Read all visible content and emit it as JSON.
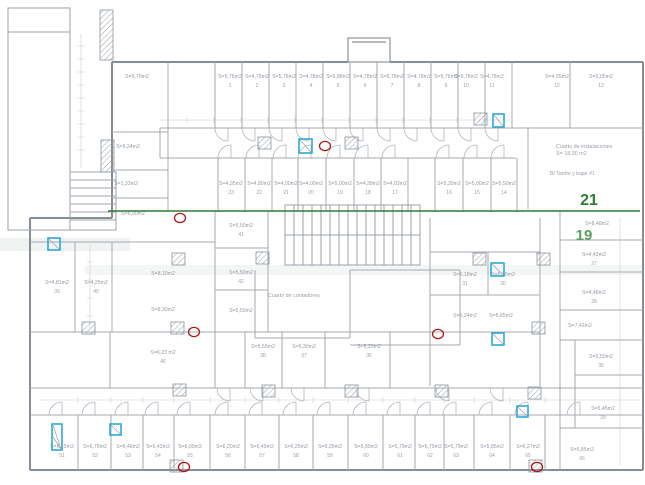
{
  "colors": {
    "wall": "#858d96",
    "partition": "#a4aab2",
    "thin": "#bfc5cb",
    "label_text": "#939aa3",
    "green_line": "#2e7d32",
    "green_label_21": "#2e7d32",
    "green_label_19": "#58a05c",
    "blue_marker": "#2fa8d5",
    "red_marker": "#b01818",
    "hatch": "#9aa1a9"
  },
  "annotations": {
    "green_line": {
      "x1": 108,
      "y1": 211,
      "x2": 640,
      "y2": 211
    },
    "labels": [
      {
        "text": "21",
        "x": 589,
        "y": 205,
        "size": 16,
        "color": "#2e7d32"
      },
      {
        "text": "19",
        "x": 584,
        "y": 240,
        "size": 15,
        "color": "#58a05c"
      }
    ]
  },
  "special_texts": [
    {
      "text": "Cuarto de instalaciones",
      "x": 556,
      "y": 148,
      "size": 5.4,
      "anchor": "start"
    },
    {
      "text": "S= 18,30 m2",
      "x": 556,
      "y": 155,
      "size": 5.4,
      "anchor": "start"
    },
    {
      "text": "B/ Tarrito y bajar #1",
      "x": 550,
      "y": 175,
      "size": 5.2,
      "anchor": "start"
    },
    {
      "text": "Cuarto de contadores",
      "x": 268,
      "y": 297,
      "size": 5.4,
      "anchor": "start"
    }
  ],
  "rooms": [
    {
      "a": "S=9,70m2",
      "n": "",
      "x": 137,
      "y": 78
    },
    {
      "a": "S=5,24m2",
      "n": "",
      "x": 128,
      "y": 148
    },
    {
      "a": "S=1,33m2",
      "n": "",
      "x": 126,
      "y": 185
    },
    {
      "a": "S=6,00m2",
      "n": "",
      "x": 133,
      "y": 215
    },
    {
      "a": "S=8,10m2",
      "n": "",
      "x": 163,
      "y": 275
    },
    {
      "a": "S=8,30m2",
      "n": "",
      "x": 163,
      "y": 311
    },
    {
      "a": "S=4,81m2",
      "n": "39",
      "x": 57,
      "y": 284
    },
    {
      "a": "S=4,25m2",
      "n": "40",
      "x": 96,
      "y": 284
    },
    {
      "a": "S=6,23 m2",
      "n": "46",
      "x": 163,
      "y": 354
    },
    {
      "a": "S=5,76m2",
      "n": "1",
      "x": 230,
      "y": 78
    },
    {
      "a": "S=4,78m2",
      "n": "2",
      "x": 257,
      "y": 78
    },
    {
      "a": "S=5,78m2",
      "n": "3",
      "x": 284,
      "y": 78
    },
    {
      "a": "S=4,78m2",
      "n": "4",
      "x": 311,
      "y": 78
    },
    {
      "a": "S=5,88m2",
      "n": "5",
      "x": 338,
      "y": 78
    },
    {
      "a": "S=4,78m2",
      "n": "6",
      "x": 365,
      "y": 78
    },
    {
      "a": "S=5,78m2",
      "n": "7",
      "x": 392,
      "y": 78
    },
    {
      "a": "S=4,78m2",
      "n": "8",
      "x": 419,
      "y": 78
    },
    {
      "a": "S=5,76m2",
      "n": "9",
      "x": 446,
      "y": 78
    },
    {
      "a": "S=5,78m2",
      "n": "10",
      "x": 466,
      "y": 78
    },
    {
      "a": "S=4,78m2",
      "n": "11",
      "x": 492,
      "y": 78
    },
    {
      "a": "S=4,55m2",
      "n": "12",
      "x": 557,
      "y": 78
    },
    {
      "a": "S=5,05m2",
      "n": "13",
      "x": 601,
      "y": 78
    },
    {
      "a": "S=4,35m2",
      "n": "23",
      "x": 231,
      "y": 185
    },
    {
      "a": "S=4,80m2",
      "n": "22",
      "x": 259,
      "y": 185
    },
    {
      "a": "S=4,00m2",
      "n": "21",
      "x": 286,
      "y": 185
    },
    {
      "a": "S=4,00m2",
      "n": "20",
      "x": 311,
      "y": 185
    },
    {
      "a": "S=5,00m2",
      "n": "19",
      "x": 340,
      "y": 185
    },
    {
      "a": "S=4,39m2",
      "n": "18",
      "x": 368,
      "y": 185
    },
    {
      "a": "S=4,03m2",
      "n": "17",
      "x": 395,
      "y": 185
    },
    {
      "a": "S=5,30m2",
      "n": "16",
      "x": 449,
      "y": 185
    },
    {
      "a": "S=5,00m2",
      "n": "15",
      "x": 477,
      "y": 185
    },
    {
      "a": "S=5,50m2",
      "n": "14",
      "x": 504,
      "y": 185
    },
    {
      "a": "S=5,50m2",
      "n": "41",
      "x": 241,
      "y": 227
    },
    {
      "a": "S=5,50m2",
      "n": "42",
      "x": 241,
      "y": 274
    },
    {
      "a": "S=5,50m2",
      "n": "",
      "x": 241,
      "y": 312
    },
    {
      "a": "S=5,18m2",
      "n": "31",
      "x": 465,
      "y": 276
    },
    {
      "a": "S=5,30m2",
      "n": "30",
      "x": 503,
      "y": 276
    },
    {
      "a": "S=6,24m2",
      "n": "",
      "x": 465,
      "y": 317
    },
    {
      "a": "S=5,65m2",
      "n": "",
      "x": 501,
      "y": 317
    },
    {
      "a": "S=5,59m2",
      "n": "38",
      "x": 263,
      "y": 348
    },
    {
      "a": "S=5,30m2",
      "n": "37",
      "x": 304,
      "y": 348
    },
    {
      "a": "S=5,20m2",
      "n": "36",
      "x": 369,
      "y": 348
    },
    {
      "a": "S=8,48m2",
      "n": "",
      "x": 597,
      "y": 225
    },
    {
      "a": "S=4,43m2",
      "n": "27",
      "x": 594,
      "y": 256
    },
    {
      "a": "S=4,48m2",
      "n": "28",
      "x": 594,
      "y": 294
    },
    {
      "a": "S=7,42m2",
      "n": "",
      "x": 580,
      "y": 327
    },
    {
      "a": "S=5,50m2",
      "n": "35",
      "x": 601,
      "y": 358
    },
    {
      "a": "S=5,45m2",
      "n": "29",
      "x": 603,
      "y": 410
    },
    {
      "a": "S=6,85m2",
      "n": "66",
      "x": 582,
      "y": 451
    },
    {
      "a": "S=6,15m2",
      "n": "51",
      "x": 62,
      "y": 448
    },
    {
      "a": "S=6,76m2",
      "n": "52",
      "x": 95,
      "y": 448
    },
    {
      "a": "S=6,48m2",
      "n": "53",
      "x": 128,
      "y": 448
    },
    {
      "a": "S=6,43m2",
      "n": "54",
      "x": 158,
      "y": 448
    },
    {
      "a": "S=6,00m2",
      "n": "55",
      "x": 190,
      "y": 448
    },
    {
      "a": "S=6,20m2",
      "n": "56",
      "x": 228,
      "y": 448
    },
    {
      "a": "S=6,49m2",
      "n": "57",
      "x": 262,
      "y": 448
    },
    {
      "a": "S=6,25m2",
      "n": "58",
      "x": 296,
      "y": 448
    },
    {
      "a": "S=6,25m2",
      "n": "59",
      "x": 330,
      "y": 448
    },
    {
      "a": "S=5,80m2",
      "n": "60",
      "x": 366,
      "y": 448
    },
    {
      "a": "S=5,79m2",
      "n": "61",
      "x": 400,
      "y": 448
    },
    {
      "a": "S=6,79m2",
      "n": "62",
      "x": 430,
      "y": 448
    },
    {
      "a": "S=5,79m2",
      "n": "63",
      "x": 456,
      "y": 448
    },
    {
      "a": "S=5,85m2",
      "n": "64",
      "x": 492,
      "y": 448
    },
    {
      "a": "S=6,27m2",
      "n": "65",
      "x": 528,
      "y": 448
    }
  ],
  "markers": {
    "blue": [
      {
        "x": 48,
        "y": 238,
        "w": 12,
        "h": 12
      },
      {
        "x": 299,
        "y": 139,
        "w": 13,
        "h": 14
      },
      {
        "x": 493,
        "y": 114,
        "w": 11,
        "h": 13
      },
      {
        "x": 491,
        "y": 263,
        "w": 13,
        "h": 13
      },
      {
        "x": 492,
        "y": 333,
        "w": 12,
        "h": 12
      },
      {
        "x": 517,
        "y": 406,
        "w": 11,
        "h": 11
      },
      {
        "x": 52,
        "y": 424,
        "w": 10,
        "h": 26
      },
      {
        "x": 110,
        "y": 424,
        "w": 11,
        "h": 11
      }
    ],
    "red": [
      {
        "x": 325,
        "y": 146
      },
      {
        "x": 180,
        "y": 218
      },
      {
        "x": 194,
        "y": 332
      },
      {
        "x": 438,
        "y": 334
      },
      {
        "x": 184,
        "y": 467
      },
      {
        "x": 537,
        "y": 467
      }
    ]
  },
  "pillars": [
    {
      "x": 258,
      "y": 137
    },
    {
      "x": 345,
      "y": 137
    },
    {
      "x": 474,
      "y": 113
    },
    {
      "x": 172,
      "y": 253
    },
    {
      "x": 256,
      "y": 252
    },
    {
      "x": 473,
      "y": 253
    },
    {
      "x": 537,
      "y": 253
    },
    {
      "x": 171,
      "y": 322
    },
    {
      "x": 532,
      "y": 322
    },
    {
      "x": 82,
      "y": 322
    },
    {
      "x": 173,
      "y": 384
    },
    {
      "x": 262,
      "y": 385
    },
    {
      "x": 345,
      "y": 385
    },
    {
      "x": 435,
      "y": 385
    },
    {
      "x": 528,
      "y": 387
    },
    {
      "x": 170,
      "y": 460
    },
    {
      "x": 529,
      "y": 460
    }
  ]
}
